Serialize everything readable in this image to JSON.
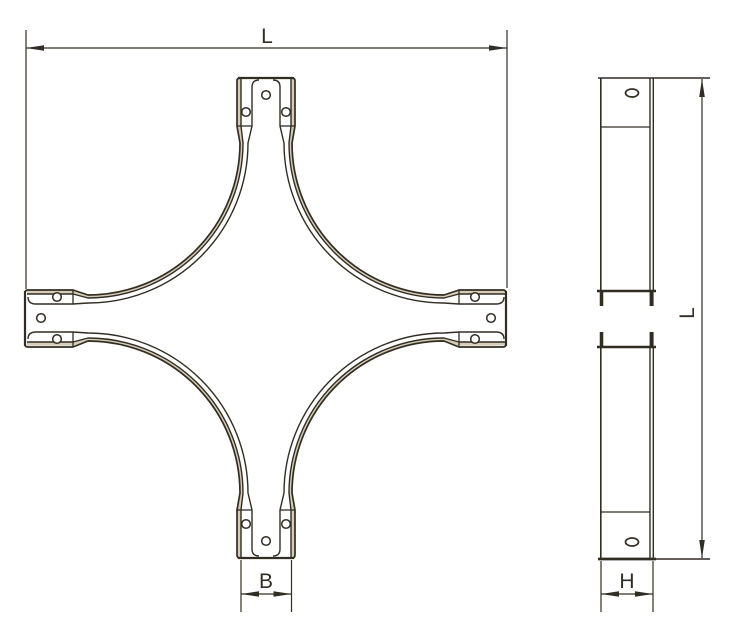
{
  "labels": {
    "plan_top": "L",
    "plan_bottom": "B",
    "side_right": "L",
    "side_bottom": "H"
  },
  "colors": {
    "line": "#322d23",
    "shade": "#d5cdb8",
    "background": "#ffffff"
  }
}
